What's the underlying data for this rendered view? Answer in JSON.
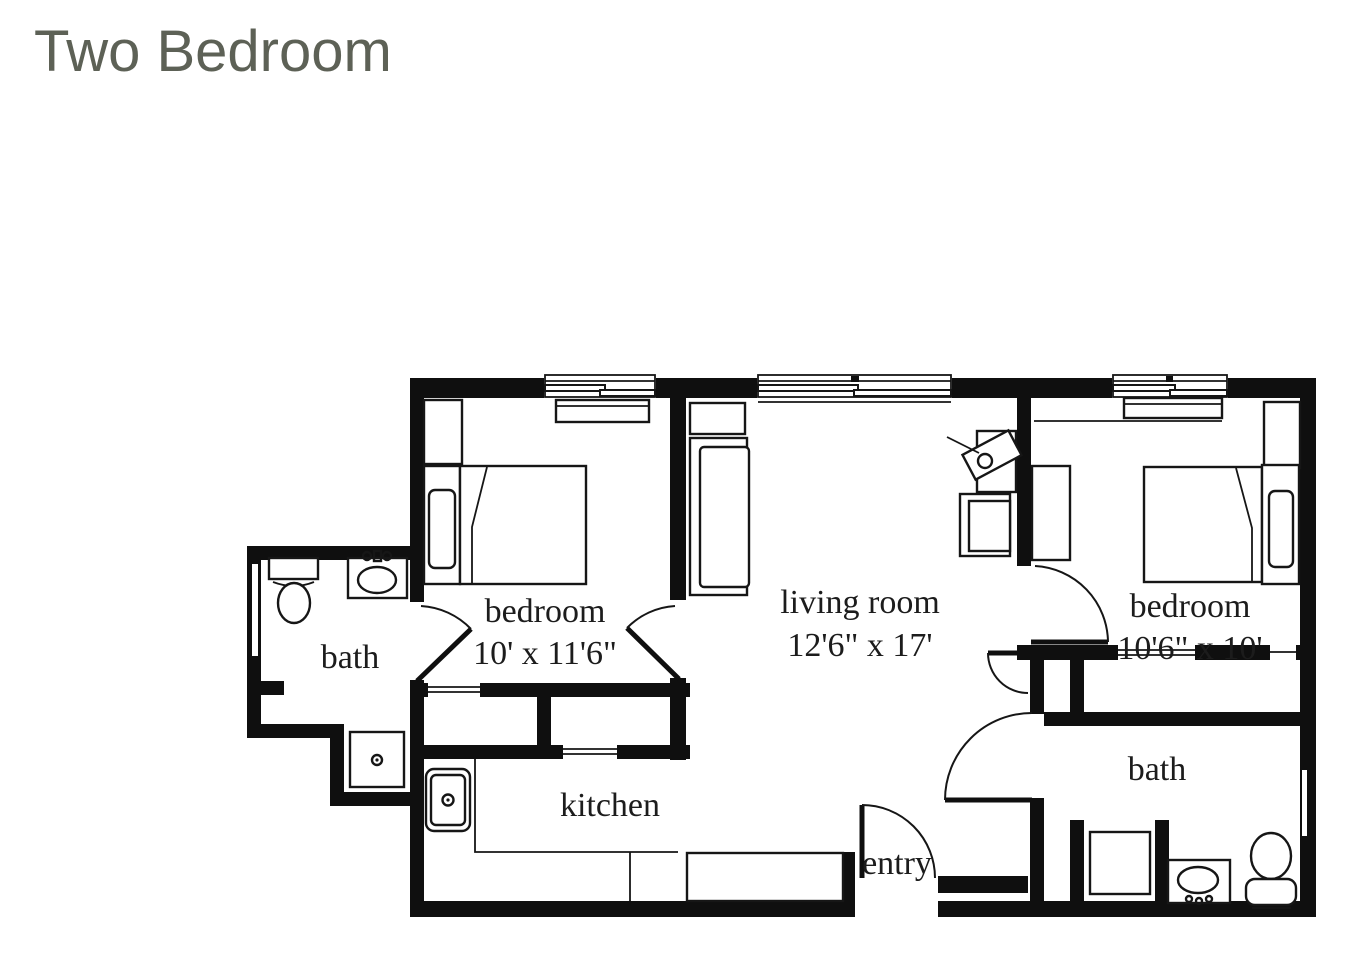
{
  "page_title": "Two Bedroom",
  "floor_plan": {
    "rooms": [
      {
        "name": "bedroom",
        "dimensions": "10' x 11'6\""
      },
      {
        "name": "living room",
        "dimensions": "12'6\" x 17'"
      },
      {
        "name": "bedroom",
        "dimensions": "10'6\" x 10'"
      },
      {
        "name": "bath"
      },
      {
        "name": "kitchen"
      },
      {
        "name": "entry"
      },
      {
        "name": "bath"
      }
    ],
    "colors": {
      "walls": "#0f0f0f",
      "background": "#ffffff",
      "label_text": "#1c1c1c",
      "title_text": "#5d6156"
    }
  }
}
